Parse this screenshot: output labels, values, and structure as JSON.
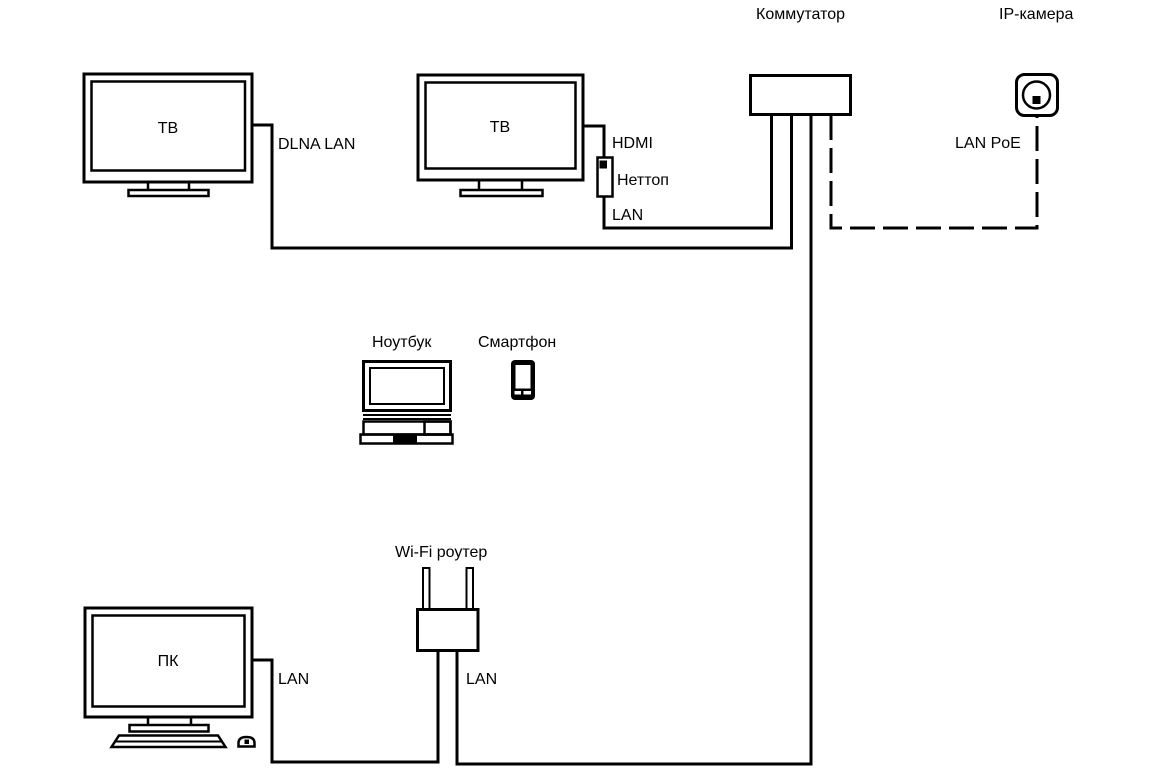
{
  "page": {
    "background": "#ffffff",
    "line_color": "#000000",
    "text_color": "#000000"
  },
  "diagram": {
    "nodes": {
      "tv1": {
        "label": "ТВ",
        "type": "tv"
      },
      "tv2": {
        "label": "ТВ",
        "type": "tv"
      },
      "nettop": {
        "label": "Неттоп",
        "type": "mini-pc"
      },
      "switch": {
        "label": "Коммутатор",
        "type": "network-switch"
      },
      "ip_camera": {
        "label": "IP-камера",
        "type": "camera"
      },
      "laptop": {
        "label": "Ноутбук",
        "type": "laptop"
      },
      "smartphone": {
        "label": "Смартфон",
        "type": "smartphone"
      },
      "router": {
        "label": "Wi-Fi роутер",
        "type": "wifi-router"
      },
      "pc": {
        "label": "ПК",
        "type": "desktop-pc"
      }
    },
    "links": {
      "tv1_to_switch": {
        "label": "DLNA LAN",
        "style": "solid"
      },
      "tv2_to_nettop": {
        "label": "HDMI",
        "style": "solid"
      },
      "nettop_to_switch": {
        "label": "LAN",
        "style": "solid"
      },
      "switch_to_camera": {
        "label": "LAN PoE",
        "style": "dashed"
      },
      "pc_to_router": {
        "label": "LAN",
        "style": "solid"
      },
      "router_to_switch": {
        "label": "LAN",
        "style": "solid"
      }
    }
  }
}
